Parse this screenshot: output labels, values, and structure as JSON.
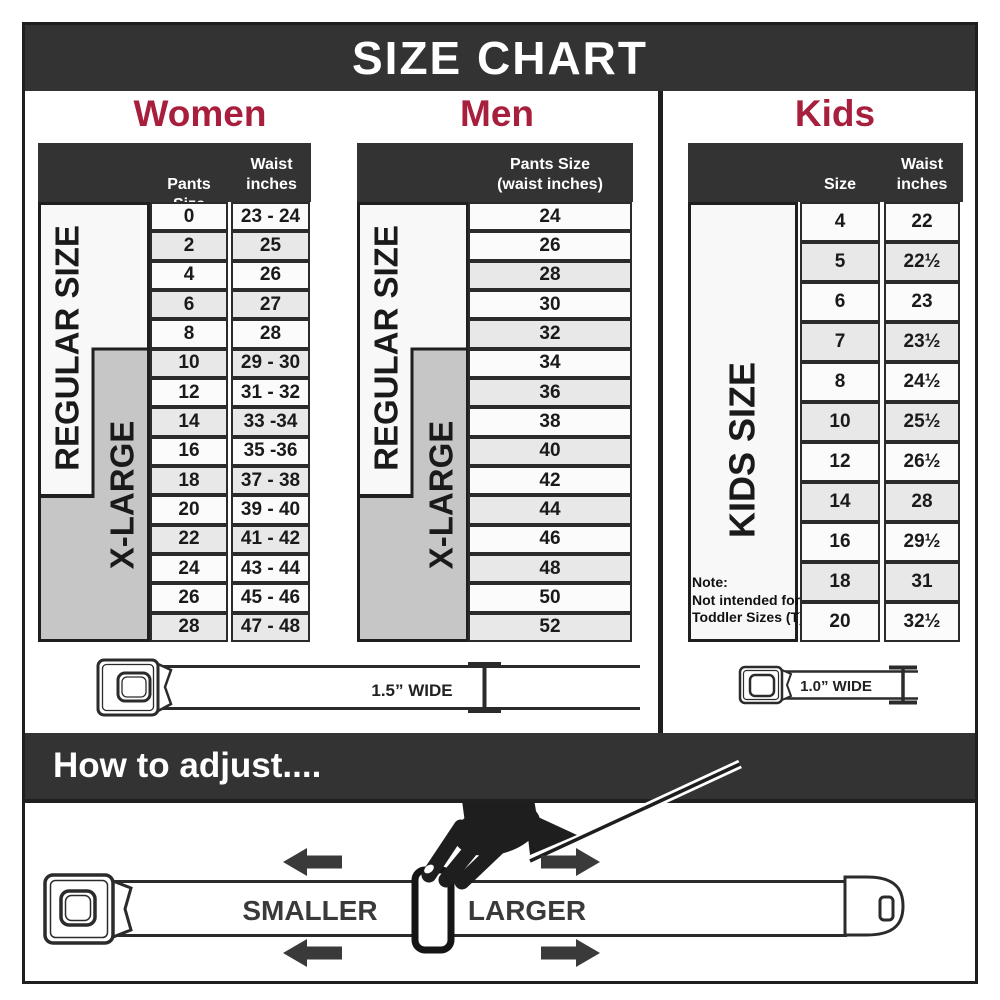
{
  "title": "SIZE CHART",
  "colors": {
    "accent": "#A81F3D",
    "dark_bar": "#333333",
    "shaded_row": "#e8e8e8",
    "xlarge_gray": "#c6c6c6"
  },
  "women": {
    "heading": "Women",
    "col_pants": "Pants Size",
    "col_waist_1": "Waist",
    "col_waist_2": "inches",
    "regular_label": "REGULAR SIZE",
    "xlarge_label": "X-LARGE",
    "rows": [
      {
        "size": "0",
        "waist": "23 - 24",
        "shaded": false
      },
      {
        "size": "2",
        "waist": "25",
        "shaded": true
      },
      {
        "size": "4",
        "waist": "26",
        "shaded": false
      },
      {
        "size": "6",
        "waist": "27",
        "shaded": true
      },
      {
        "size": "8",
        "waist": "28",
        "shaded": false
      },
      {
        "size": "10",
        "waist": "29 - 30",
        "shaded": true
      },
      {
        "size": "12",
        "waist": "31 - 32",
        "shaded": false
      },
      {
        "size": "14",
        "waist": "33 -34",
        "shaded": true
      },
      {
        "size": "16",
        "waist": "35 -36",
        "shaded": false
      },
      {
        "size": "18",
        "waist": "37 - 38",
        "shaded": true
      },
      {
        "size": "20",
        "waist": "39 - 40",
        "shaded": false
      },
      {
        "size": "22",
        "waist": "41 - 42",
        "shaded": true
      },
      {
        "size": "24",
        "waist": "43 - 44",
        "shaded": false
      },
      {
        "size": "26",
        "waist": "45 - 46",
        "shaded": false
      },
      {
        "size": "28",
        "waist": "47 - 48",
        "shaded": true
      }
    ]
  },
  "men": {
    "heading": "Men",
    "header_1": "Pants Size",
    "header_2": "(waist inches)",
    "regular_label": "REGULAR SIZE",
    "xlarge_label": "X-LARGE",
    "rows": [
      {
        "size": "24",
        "shaded": false
      },
      {
        "size": "26",
        "shaded": false
      },
      {
        "size": "28",
        "shaded": true
      },
      {
        "size": "30",
        "shaded": false
      },
      {
        "size": "32",
        "shaded": true
      },
      {
        "size": "34",
        "shaded": false
      },
      {
        "size": "36",
        "shaded": true
      },
      {
        "size": "38",
        "shaded": false
      },
      {
        "size": "40",
        "shaded": true
      },
      {
        "size": "42",
        "shaded": false
      },
      {
        "size": "44",
        "shaded": true
      },
      {
        "size": "46",
        "shaded": false
      },
      {
        "size": "48",
        "shaded": true
      },
      {
        "size": "50",
        "shaded": false
      },
      {
        "size": "52",
        "shaded": true
      }
    ]
  },
  "kids": {
    "heading": "Kids",
    "col_size": "Size",
    "col_waist_1": "Waist",
    "col_waist_2": "inches",
    "side_label": "KIDS SIZE",
    "note_1": "Note:",
    "note_2": "Not intended for",
    "note_3": "Toddler Sizes (T)",
    "rows": [
      {
        "size": "4",
        "waist": "22",
        "shaded": false
      },
      {
        "size": "5",
        "waist": "22½",
        "shaded": true
      },
      {
        "size": "6",
        "waist": "23",
        "shaded": false
      },
      {
        "size": "7",
        "waist": "23½",
        "shaded": true
      },
      {
        "size": "8",
        "waist": "24½",
        "shaded": false
      },
      {
        "size": "10",
        "waist": "25½",
        "shaded": true
      },
      {
        "size": "12",
        "waist": "26½",
        "shaded": false
      },
      {
        "size": "14",
        "waist": "28",
        "shaded": true
      },
      {
        "size": "16",
        "waist": "29½",
        "shaded": false
      },
      {
        "size": "18",
        "waist": "31",
        "shaded": true
      },
      {
        "size": "20",
        "waist": "32½",
        "shaded": false
      }
    ]
  },
  "belts": {
    "adult_width": "1.5” WIDE",
    "kids_width": "1.0” WIDE"
  },
  "adjust": {
    "heading": "How to adjust....",
    "smaller": "SMALLER",
    "larger": "LARGER"
  }
}
